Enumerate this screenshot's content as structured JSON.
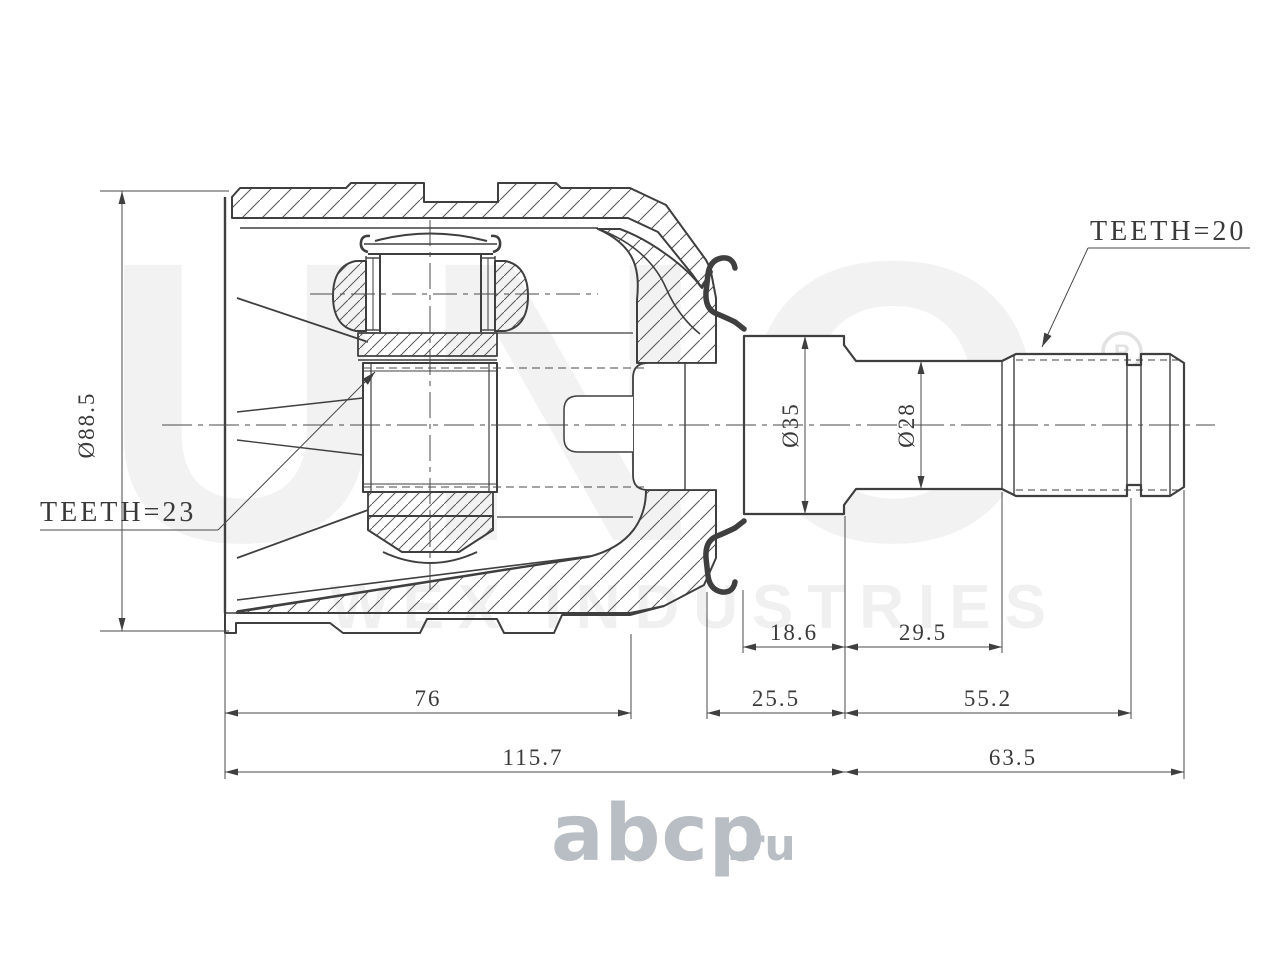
{
  "colors": {
    "line": "#3f3f3f",
    "thin_line": "#555555",
    "hatch": "#5a5a5a",
    "watermark": "#f2f2f2",
    "watermark_mark": "#e2e2e2",
    "logo": "#b9bec4",
    "background": "#ffffff"
  },
  "annotations": {
    "teeth_right": "TEETH=20",
    "teeth_left": "TEETH=23"
  },
  "dimensions": {
    "housing_diameter": "Ø88.5",
    "flange_diameter": "Ø35",
    "shaft_diameter": "Ø28",
    "seat_length": "18.6",
    "shaft_mid_length": "29.5",
    "neck_length": "25.5",
    "spline_length": "55.2",
    "housing_length": "76",
    "overall_left": "115.7",
    "overall_right": "63.5"
  },
  "watermark": {
    "brand": "UNO",
    "registered": "R",
    "tagline": "WEX INDUSTRIES"
  },
  "logo": {
    "text": "abcp",
    "suffix": ".ru"
  }
}
